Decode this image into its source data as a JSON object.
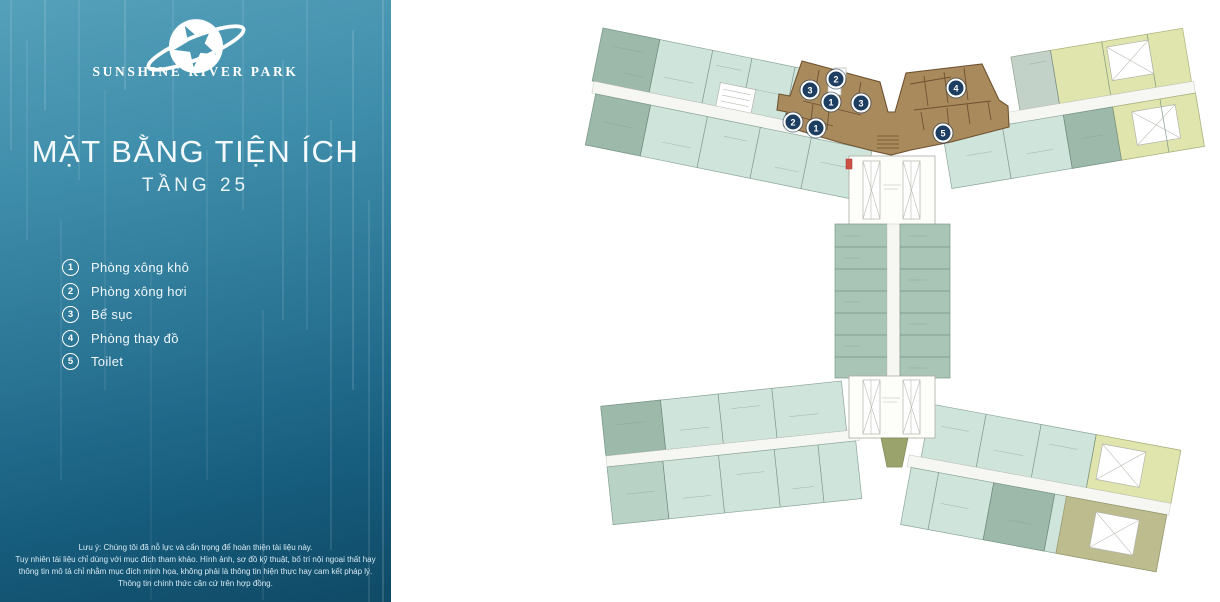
{
  "panel": {
    "brand": "SUNSHINE RIVER PARK",
    "title": "MẶT BẰNG TIỆN ÍCH",
    "subtitle": "TẦNG 25",
    "legend": {
      "items": [
        {
          "num": "1",
          "label": "Phòng xông khô"
        },
        {
          "num": "2",
          "label": "Phòng xông hơi"
        },
        {
          "num": "3",
          "label": "Bể sục"
        },
        {
          "num": "4",
          "label": "Phòng thay đồ"
        },
        {
          "num": "5",
          "label": "Toilet"
        }
      ]
    },
    "disclaimer": {
      "lines": [
        "Lưu ý: Chúng tôi đã nỗ lực và cẩn trọng để hoàn thiện tài liệu này.",
        "Tuy nhiên tài liệu chỉ dùng với mục đích tham khảo. Hình ảnh, sơ đồ kỹ thuật, bố trí nội ngoại thất hay",
        "thông tin mô tả chỉ nhằm mục đích minh họa, không phải là thông tin hiện thực hay cam kết pháp lý.",
        "Thông tin chính thức căn cứ trên hợp đồng."
      ]
    }
  },
  "plan": {
    "markers": [
      {
        "n": "2"
      },
      {
        "n": "3"
      },
      {
        "n": "1"
      },
      {
        "n": "3"
      },
      {
        "n": "2"
      },
      {
        "n": "1"
      },
      {
        "n": "4"
      },
      {
        "n": "5"
      }
    ]
  },
  "colors": {
    "panel_top": "#55a0ba",
    "panel_bottom": "#0f4a66",
    "marker_navy": "#1d3e60",
    "amenity_brown": "#a98a5d",
    "unit_teal": "#cfe4da",
    "unit_sage": "#9db9aa",
    "unit_yellow_green": "#dfe5ac",
    "unit_olive": "#bcbc8e",
    "accent_red": "#cf5044"
  }
}
